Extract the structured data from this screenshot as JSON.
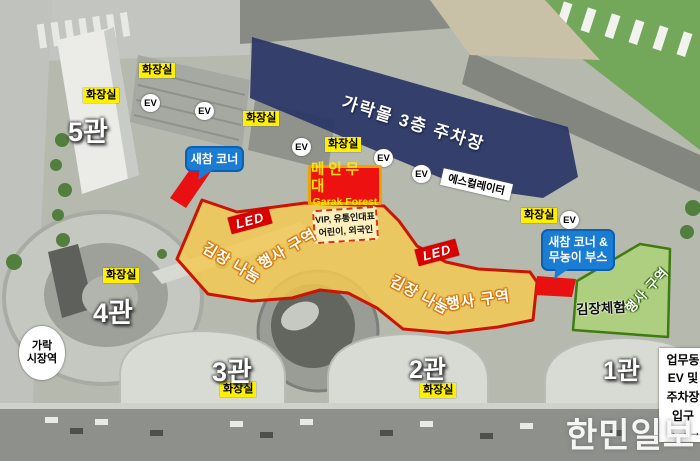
{
  "parking": {
    "label": "가락몰 3층 주차장"
  },
  "halls": {
    "h5": "5관",
    "h4": "4관",
    "h3": "3관",
    "h2": "2관",
    "h1": "1관"
  },
  "labels": {
    "toilet": "화장실",
    "ev": "EV",
    "escalator": "에스컬레이터",
    "station": {
      "line1": "가락",
      "line2": "시장역"
    },
    "office": {
      "line1": "업무동",
      "line2": "EV 및",
      "line3": "주차장",
      "line4": "입구",
      "line5": "→→→"
    }
  },
  "stage": {
    "title": "메인무대",
    "subtitle": "Garak Forest"
  },
  "vip": {
    "line1": "VIP, 유통인대표",
    "line2": "어린이, 외국인"
  },
  "zones": {
    "event_yellow": {
      "text1": "김장 나눔",
      "text2": "행사 구역"
    },
    "experience_green": {
      "label": "김장체험",
      "sub": "행사 구역"
    },
    "led": "LED"
  },
  "bubbles": {
    "snack1": "새참 코너",
    "snack2_line1": "새참 코너 &",
    "snack2_line2": "무농이 부스"
  },
  "watermark": "한민일보",
  "colors": {
    "zone_yellow": "#F3C954",
    "zone_border_red": "#CC1400",
    "parking_blue": "#2A3766",
    "experience_green": "#ADD278",
    "green_border": "#3E7C12",
    "accent_red": "#E81010",
    "label_yellow": "#FFF000",
    "bubble_blue": "#1B7CD4"
  }
}
